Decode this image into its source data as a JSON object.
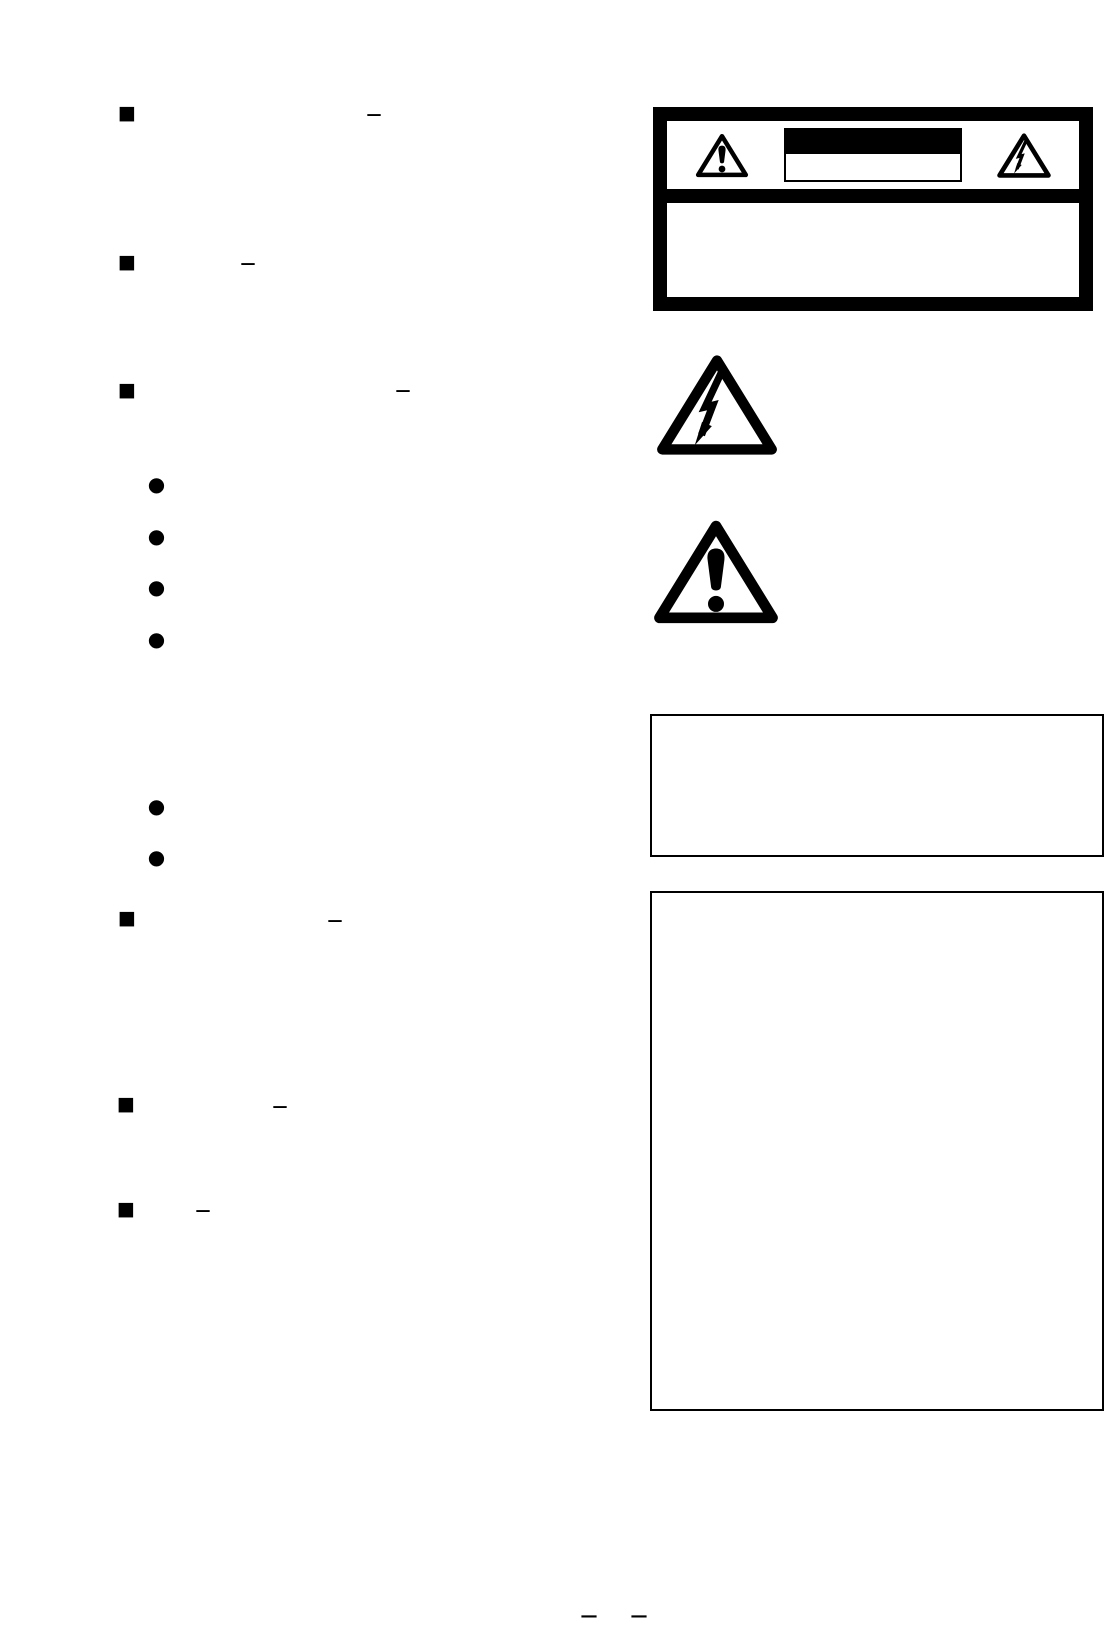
{
  "page": {
    "type": "scanned-manual-safety-page",
    "paper_color": "#ffffff",
    "ink_color": "#000000"
  },
  "left_column": {
    "sections": [
      {
        "bullet": "■",
        "dash": "—"
      },
      {
        "bullet": "■",
        "dash": "—"
      },
      {
        "bullet": "■",
        "dash": "—",
        "sub_bullet_groups": [
          4,
          2
        ]
      },
      {
        "bullet": "■",
        "dash": "—"
      },
      {
        "bullet": "■",
        "dash": "—"
      },
      {
        "bullet": "■",
        "dash": "—"
      }
    ],
    "sub_bullets": [
      {
        "bullet": "●"
      },
      {
        "bullet": "●"
      },
      {
        "bullet": "●"
      },
      {
        "bullet": "●"
      },
      {
        "bullet": "●"
      },
      {
        "bullet": "●"
      }
    ]
  },
  "caution_panel": {
    "border_color": "#000000",
    "left_icon": "exclamation-triangle-icon",
    "right_icon": "high-voltage-flash-triangle-icon",
    "title_bar": "solid-black-redacted-bar",
    "subtitle_box": "empty-outlined-box",
    "body_text": ""
  },
  "standalone_symbols": {
    "flash_icon": "high-voltage-flash-triangle-icon",
    "warning_icon": "exclamation-triangle-icon"
  },
  "notice_boxes": [
    {
      "content": ""
    },
    {
      "content": ""
    }
  ],
  "footer": {
    "dashes": [
      "—",
      "—"
    ]
  }
}
